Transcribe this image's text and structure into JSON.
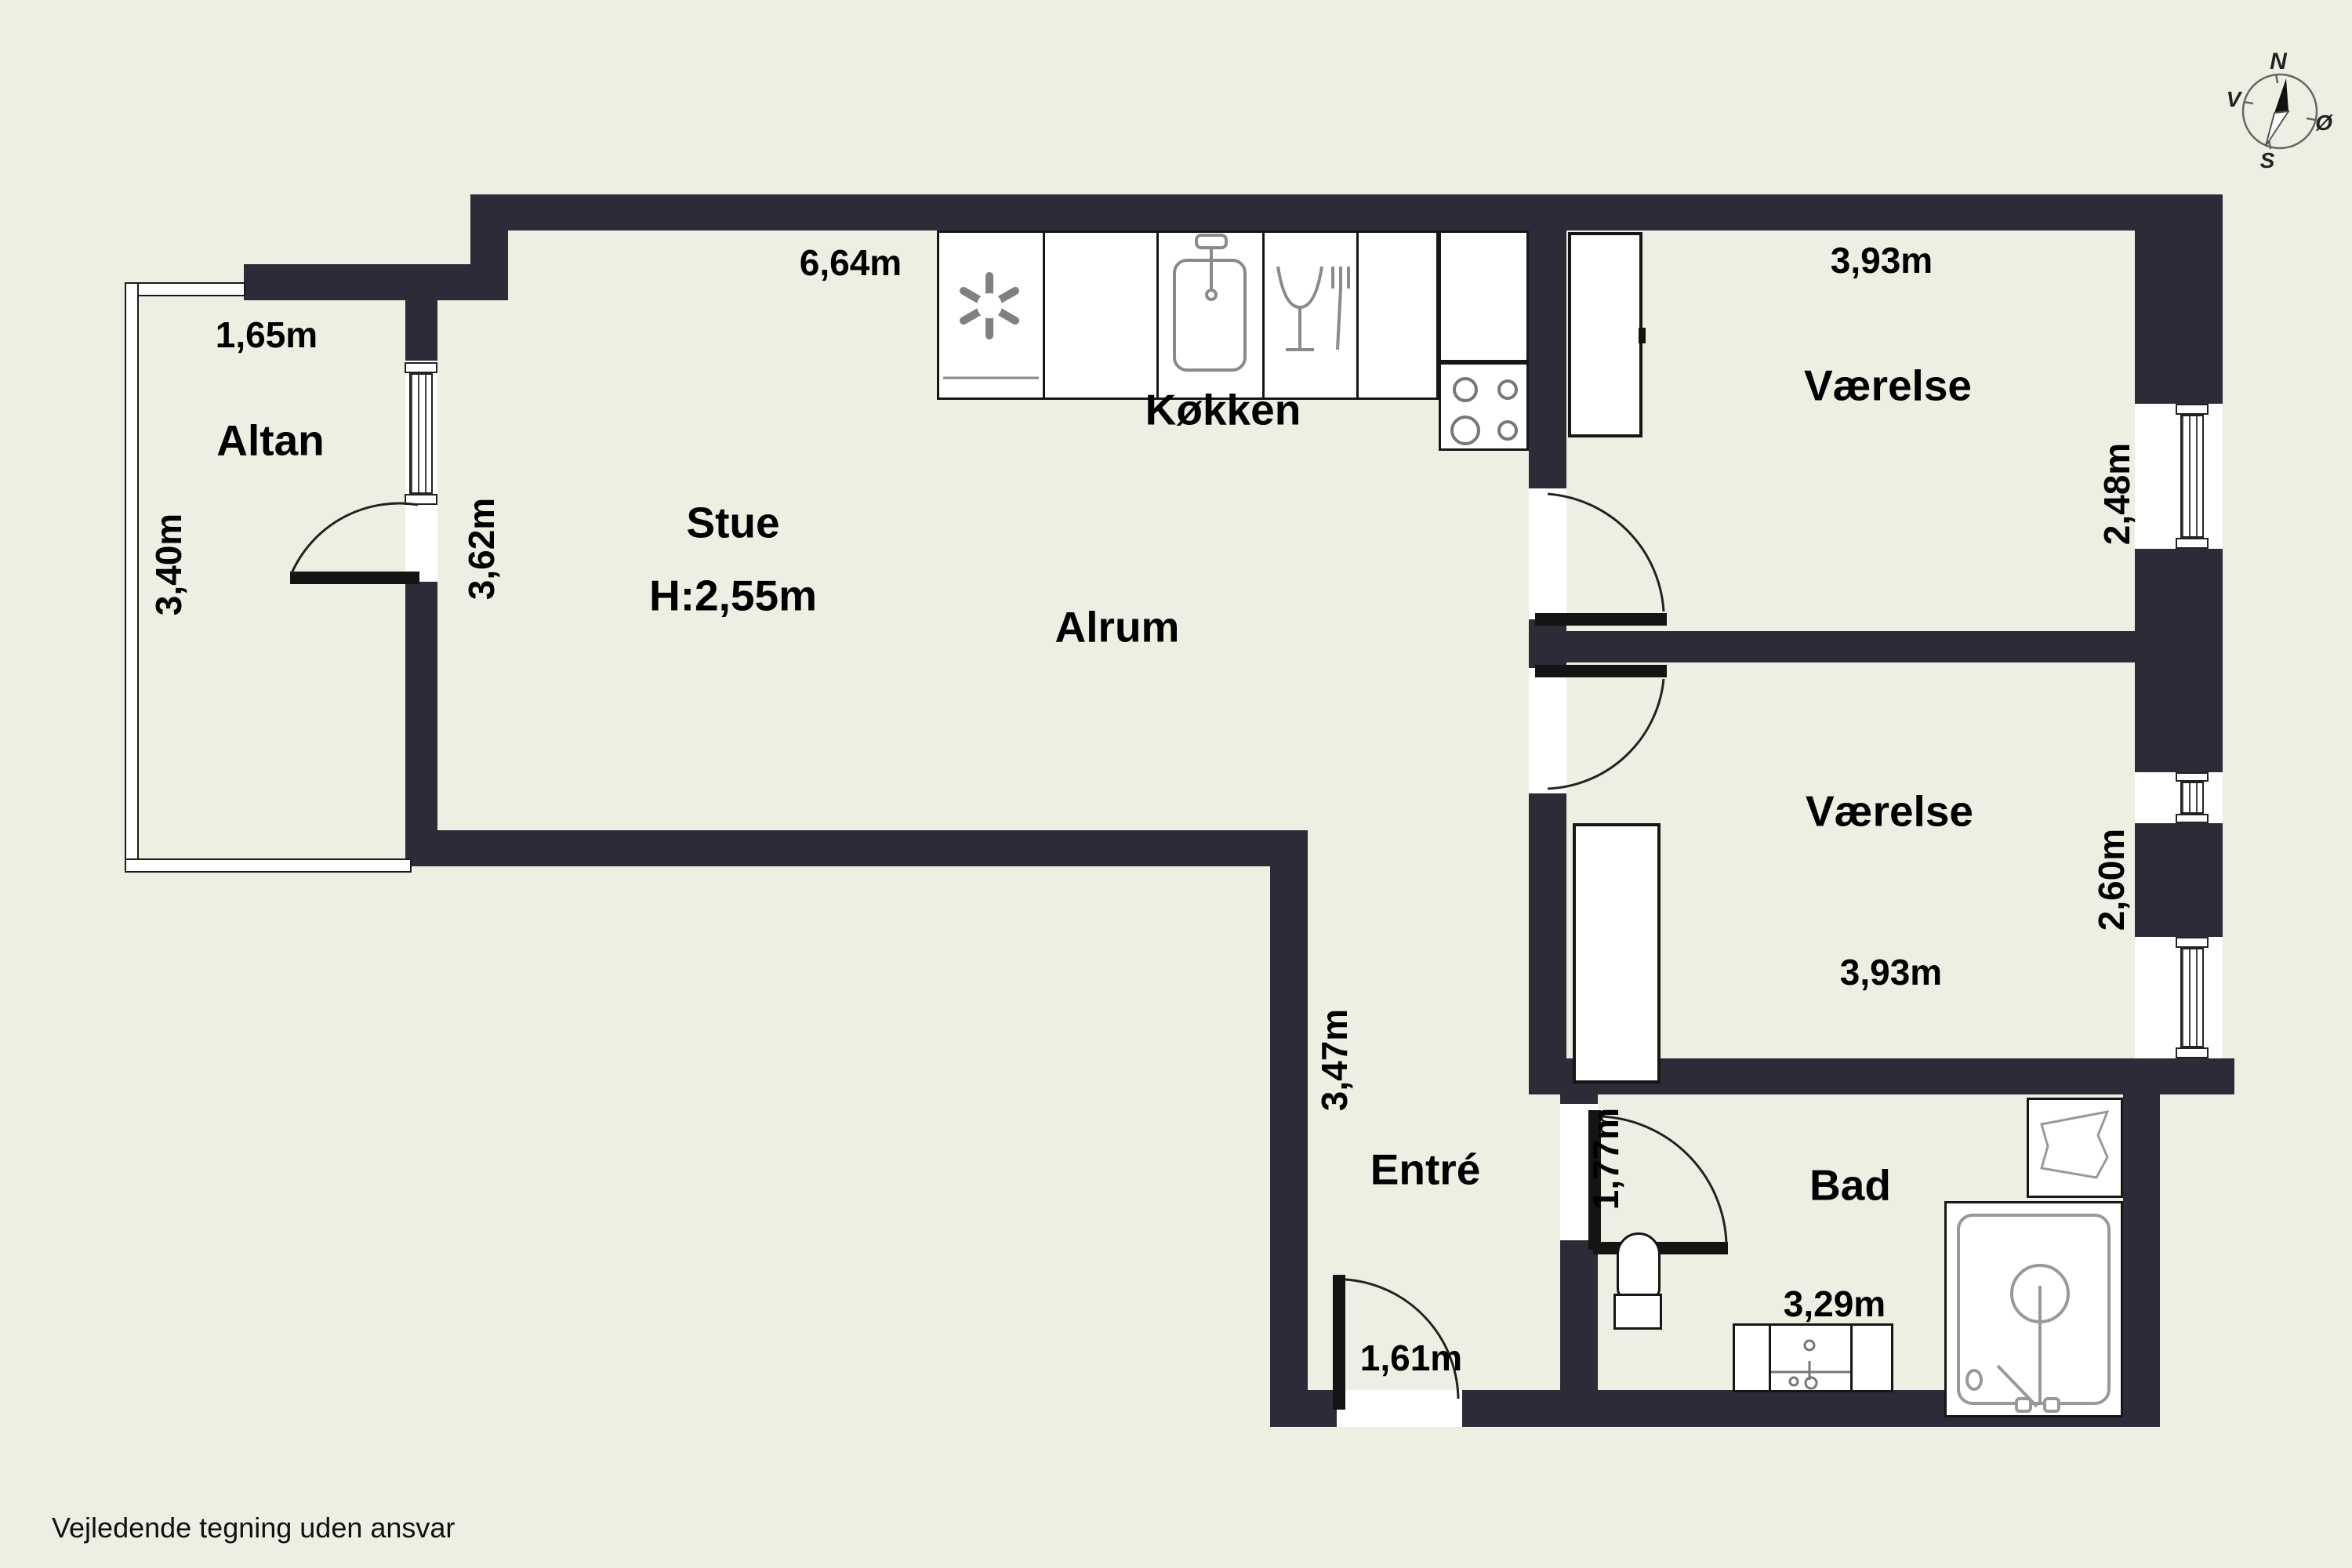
{
  "colors": {
    "background": "#efeee3",
    "wall": "#2e2a38",
    "fixture_stroke": "#8a8a8a",
    "text": "#000000"
  },
  "disclaimer": "Vejledende tegning uden ansvar",
  "compass": {
    "north": "N",
    "south": "S",
    "west": "V",
    "east": "Ø"
  },
  "rooms": {
    "altan": {
      "name": "Altan",
      "width_label": "1,65m",
      "depth_label": "3,40m"
    },
    "stue": {
      "name": "Stue",
      "ceiling_label": "H:2,55m",
      "top_label": "6,64m",
      "side_label": "3,62m"
    },
    "kokken": {
      "name": "Køkken"
    },
    "alrum": {
      "name": "Alrum"
    },
    "vaerelse_top": {
      "name": "Værelse",
      "width_label": "3,93m",
      "depth_label": "2,48m"
    },
    "vaerelse_bottom": {
      "name": "Værelse",
      "width_label": "3,93m",
      "depth_label": "2,60m"
    },
    "entre": {
      "name": "Entré",
      "depth_label": "3,47m",
      "door_label": "1,61m"
    },
    "bad": {
      "name": "Bad",
      "width_label": "3,29m",
      "door_label": "1,77m"
    }
  },
  "icons": {
    "kitchen": [
      "fan-icon",
      "sink-icon",
      "dishwasher-icon",
      "stove-burners-icon"
    ],
    "bathroom": [
      "toilet-icon",
      "vanity-sink-icon",
      "shower-icon",
      "washbasin-icon"
    ],
    "compass": "compass-rose-icon"
  }
}
